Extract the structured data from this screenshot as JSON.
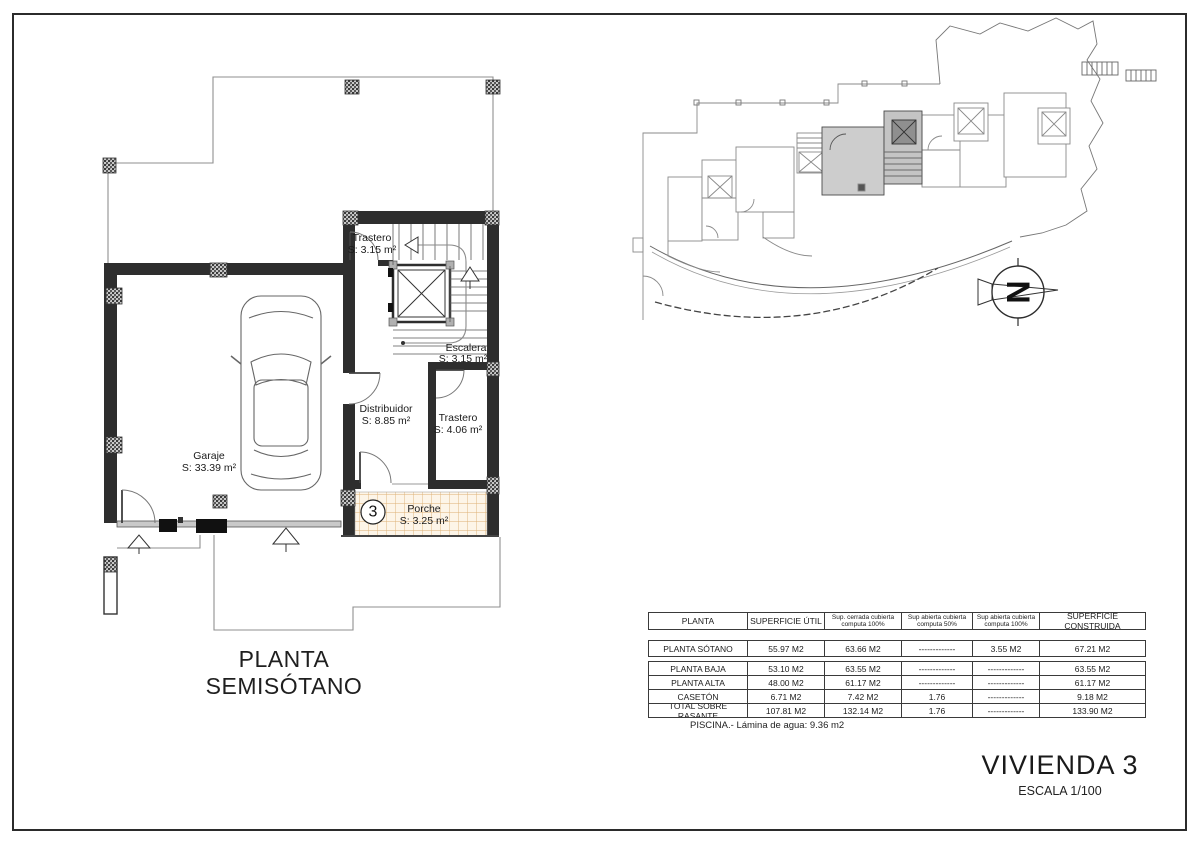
{
  "document": {
    "floor_plan_title": "PLANTA SEMISÓTANO",
    "project_title": "VIVIENDA 3",
    "scale_label": "ESCALA 1/100",
    "pool_note": "PISCINA.- Lámina de agua: 9.36 m2"
  },
  "floor_plan": {
    "unit_number": "3",
    "rooms": [
      {
        "name": "Trastero",
        "area": "S: 3.15 m²"
      },
      {
        "name": "Escalera",
        "area": "S: 3.15 m²"
      },
      {
        "name": "Distribuidor",
        "area": "S: 8.85 m²"
      },
      {
        "name": "Trastero",
        "area": "S: 4.06 m²"
      },
      {
        "name": "Garaje",
        "area": "S: 33.39 m²"
      },
      {
        "name": "Porche",
        "area": "S: 3.25 m²"
      }
    ]
  },
  "site_plan": {
    "north_label": "N",
    "highlighted_unit": "3"
  },
  "areas_table": {
    "header": [
      {
        "l1": "PLANTA",
        "l2": ""
      },
      {
        "l1": "SUPERFICIE ÚTIL",
        "l2": ""
      },
      {
        "l1": "Sup. cerrada cubierta",
        "l2": "computa 100%"
      },
      {
        "l1": "Sup abierta cubierta",
        "l2": "computa 50%"
      },
      {
        "l1": "Sup abierta cubierta",
        "l2": "computa 100%"
      },
      {
        "l1": "SUPERFICIE CONSTRUIDA",
        "l2": ""
      }
    ],
    "rows": [
      {
        "cells": [
          "PLANTA SÓTANO",
          "55.97 M2",
          "63.66 M2",
          "-------------",
          "3.55 M2",
          "67.21 M2"
        ]
      },
      {
        "cells": [
          "PLANTA BAJA",
          "53.10 M2",
          "63.55 M2",
          "-------------",
          "-------------",
          "63.55 M2"
        ]
      },
      {
        "cells": [
          "PLANTA ALTA",
          "48.00 M2",
          "61.17 M2",
          "-------------",
          "-------------",
          "61.17 M2"
        ]
      },
      {
        "cells": [
          "CASETÓN",
          "6.71 M2",
          "7.42 M2",
          "1.76",
          "-------------",
          "9.18 M2"
        ]
      },
      {
        "cells": [
          "TOTAL SOBRE RASANTE",
          "107.81 M2",
          "132.14 M2",
          "1.76",
          "-------------",
          "133.90 M2"
        ]
      }
    ]
  }
}
